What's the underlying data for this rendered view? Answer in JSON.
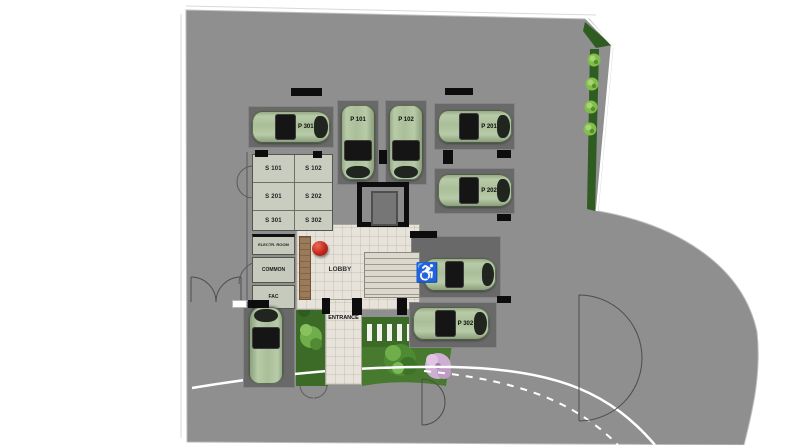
{
  "plan": {
    "areas": {
      "lobby": "LOBBY",
      "entrance": "ENTRANCE"
    },
    "storage_rooms": [
      {
        "label": "S 101"
      },
      {
        "label": "S 102"
      },
      {
        "label": "S 201"
      },
      {
        "label": "S 202"
      },
      {
        "label": "S 301"
      },
      {
        "label": "S 302"
      }
    ],
    "utility_rooms": [
      {
        "label": "ELECTR. ROOM"
      },
      {
        "label": "COMMON"
      },
      {
        "label": "FAC"
      }
    ],
    "parking_spots": [
      {
        "label": "P 301"
      },
      {
        "label": "P 101"
      },
      {
        "label": "P 102"
      },
      {
        "label": "P 201"
      },
      {
        "label": "P 202"
      },
      {
        "label": ""
      },
      {
        "label": "P 302"
      },
      {
        "label": ""
      }
    ],
    "icons": {
      "wheelchair": "♿"
    },
    "colors": {
      "site_asphalt": "#8f8f8f",
      "parking_pad": "#696969",
      "car_green": "#a9be99",
      "storage_fill": "#c9cdc0",
      "floor_tile": "#e7e3da",
      "wall_black": "#111111",
      "grass": "#47792f",
      "hedge": "#2f5c20",
      "wood": "#9a7a58",
      "accent_red": "#c0281e",
      "tree_pink": "#cfaed3",
      "street_line": "#ffffff"
    }
  }
}
